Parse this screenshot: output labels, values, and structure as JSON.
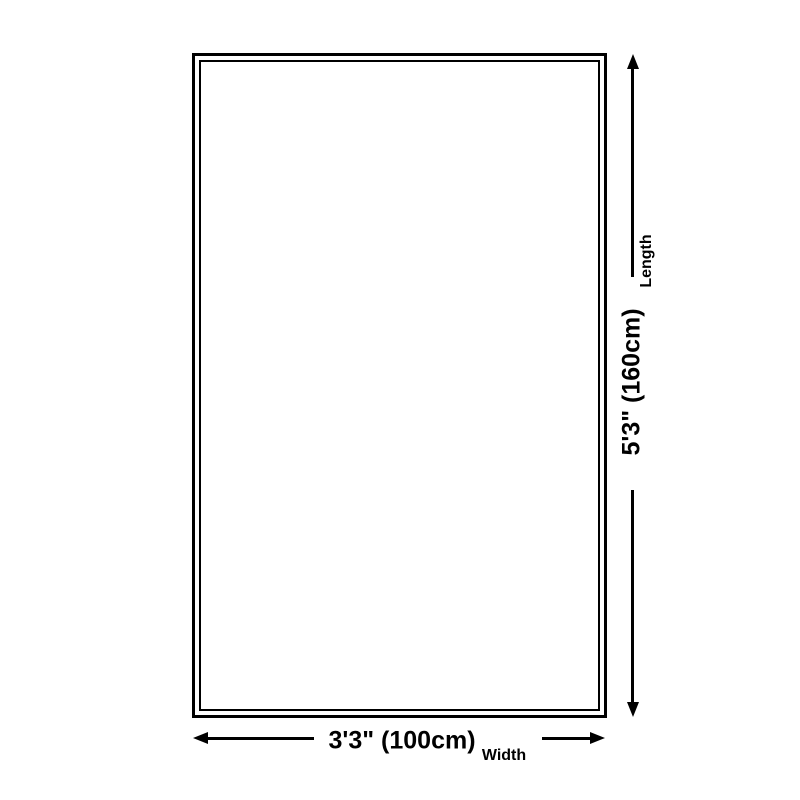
{
  "diagram": {
    "length_value": "5'3\" (160cm)",
    "length_label": "Length",
    "width_value": "3'3\" (100cm)",
    "width_label": "Width",
    "colors": {
      "line": "#000000",
      "text": "#000000",
      "background": "#ffffff"
    }
  }
}
